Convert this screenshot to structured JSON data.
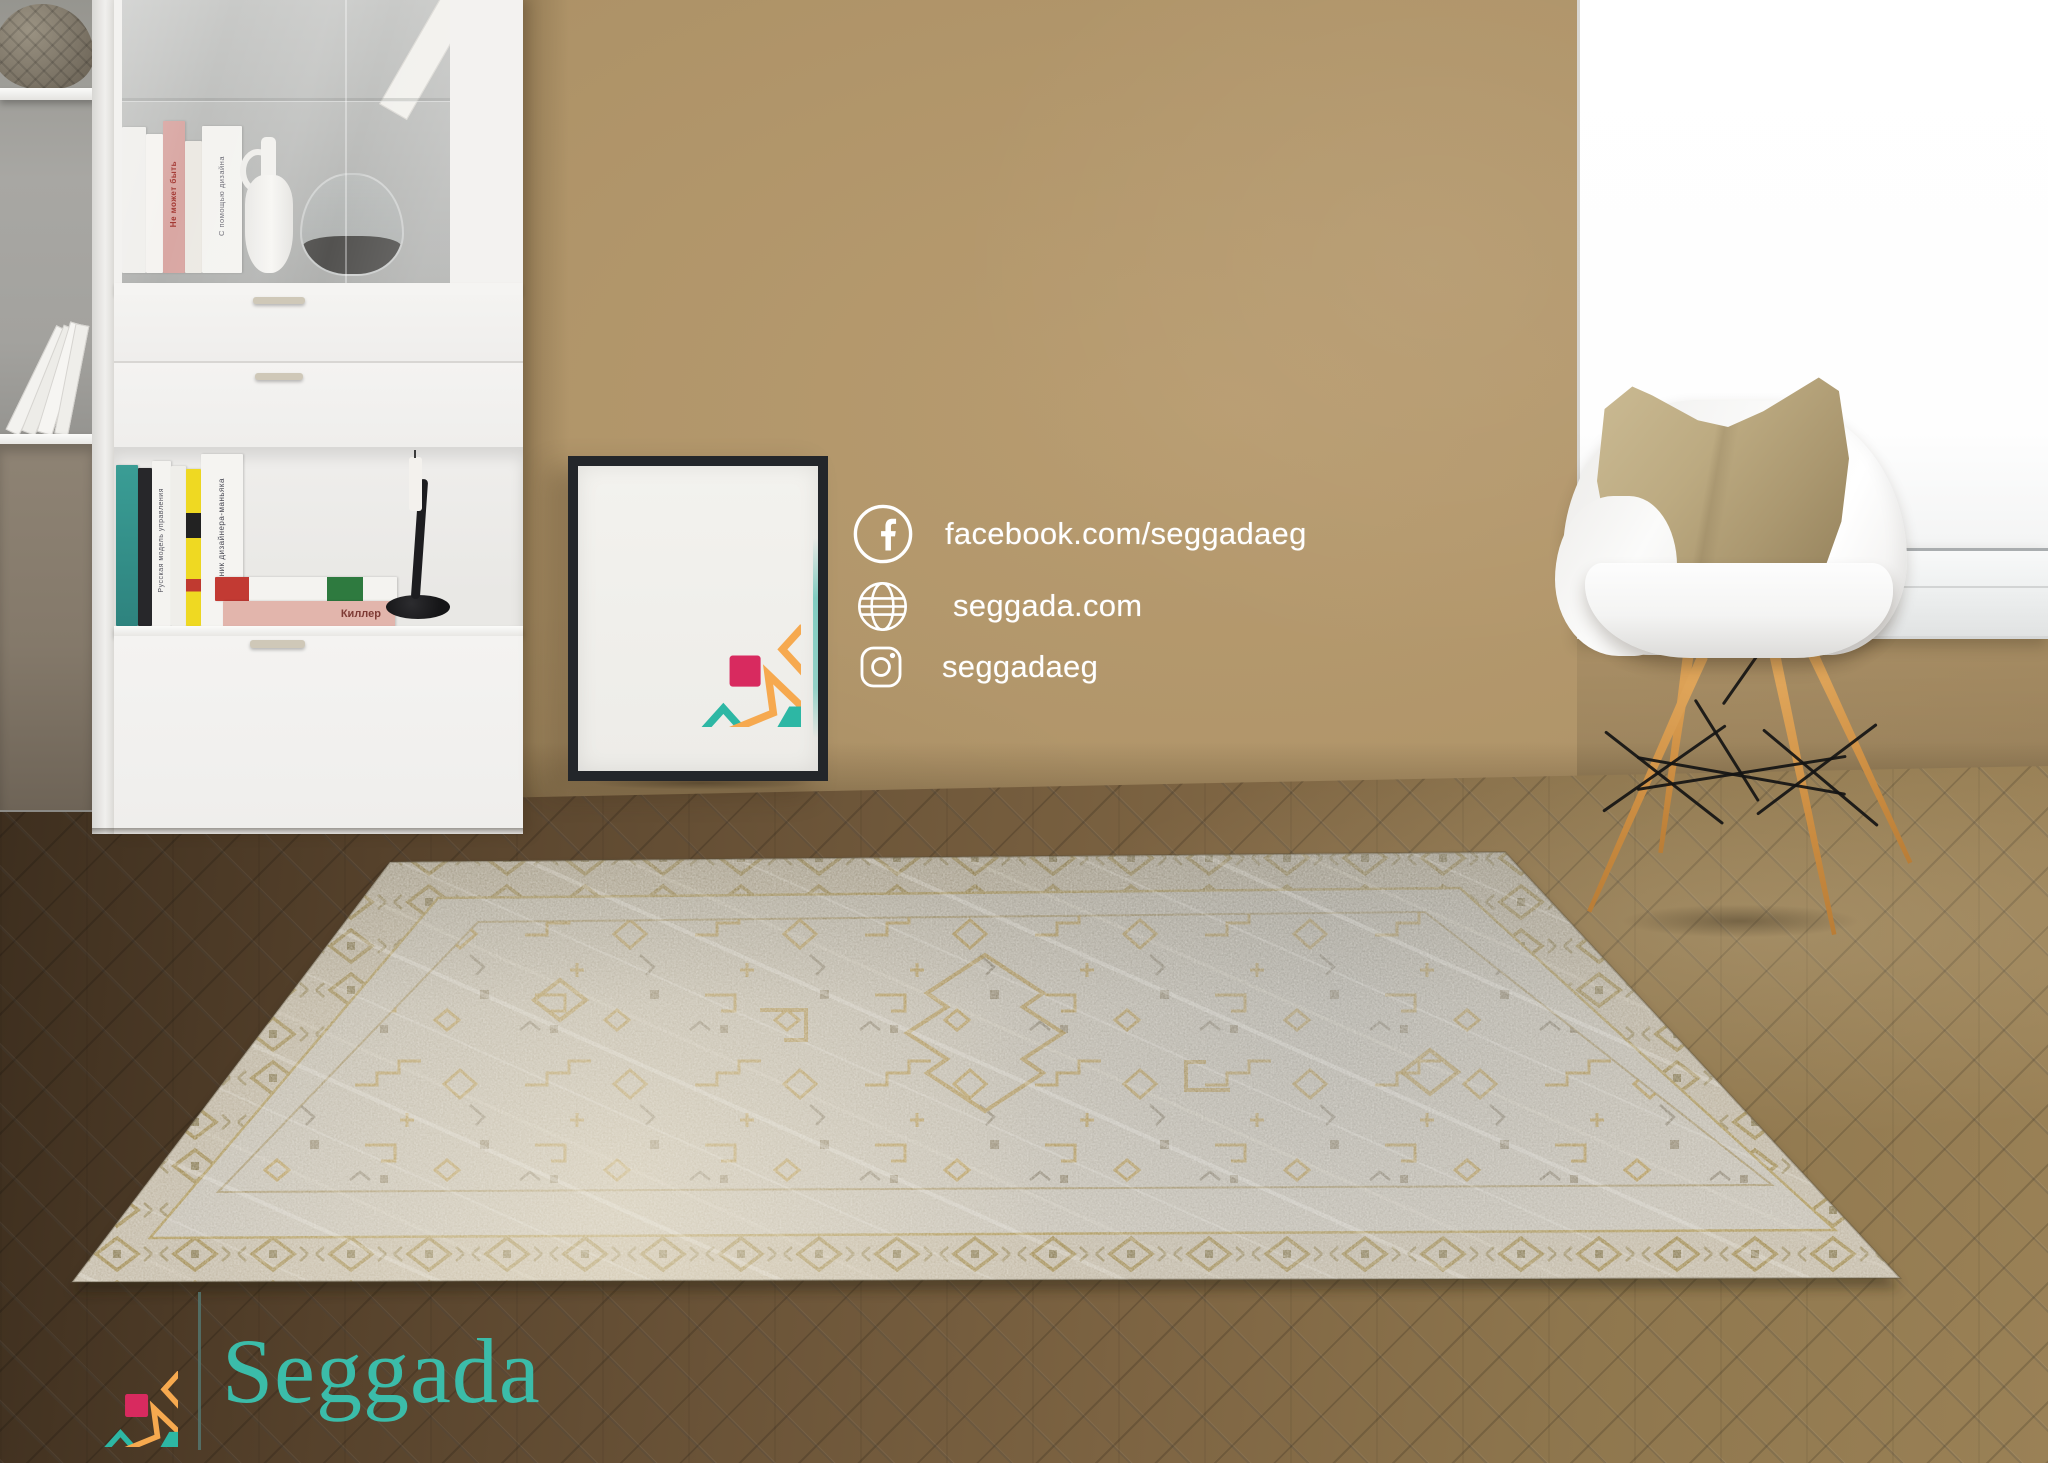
{
  "brand": {
    "wordmark": "Seggada",
    "wordmark_color": "#3BBCA9",
    "divider_color": "#53756F",
    "logo_colors": {
      "star": "#F6A94F",
      "center_hexagon": "#2DB7A4",
      "corner_squares": "#D82A5F",
      "side_diamonds": "#2DB7A4",
      "vertical_diamonds": "#F6A94F"
    }
  },
  "social": {
    "text_color": "#FFFFFF",
    "rows": [
      {
        "icon": "facebook-icon",
        "label": "facebook.com/seggadaeg"
      },
      {
        "icon": "globe-icon",
        "label": "seggada.com"
      },
      {
        "icon": "instagram-icon",
        "label": "seggadaeg"
      }
    ]
  },
  "bookshelf": {
    "glass_book_spines": [
      "Не может быть",
      "С помощью дизайна"
    ],
    "open_shelf_spines": [
      "Русская модель управления",
      "Дневник дизайнера-маньяка"
    ],
    "stacked_book_spine": "Киллер"
  },
  "palette": {
    "wall": "#AC9166",
    "floor_dark": "#4A3826",
    "floor_light": "#9A8156",
    "rug_base": "#C8C3B9",
    "rug_gold": "#B89A52",
    "window": "#FFFFFF",
    "pillow": "#B4A178",
    "chair_shell": "#F7F7F6",
    "wood_legs": "#D2954A",
    "poster_frame": "#24272B"
  }
}
